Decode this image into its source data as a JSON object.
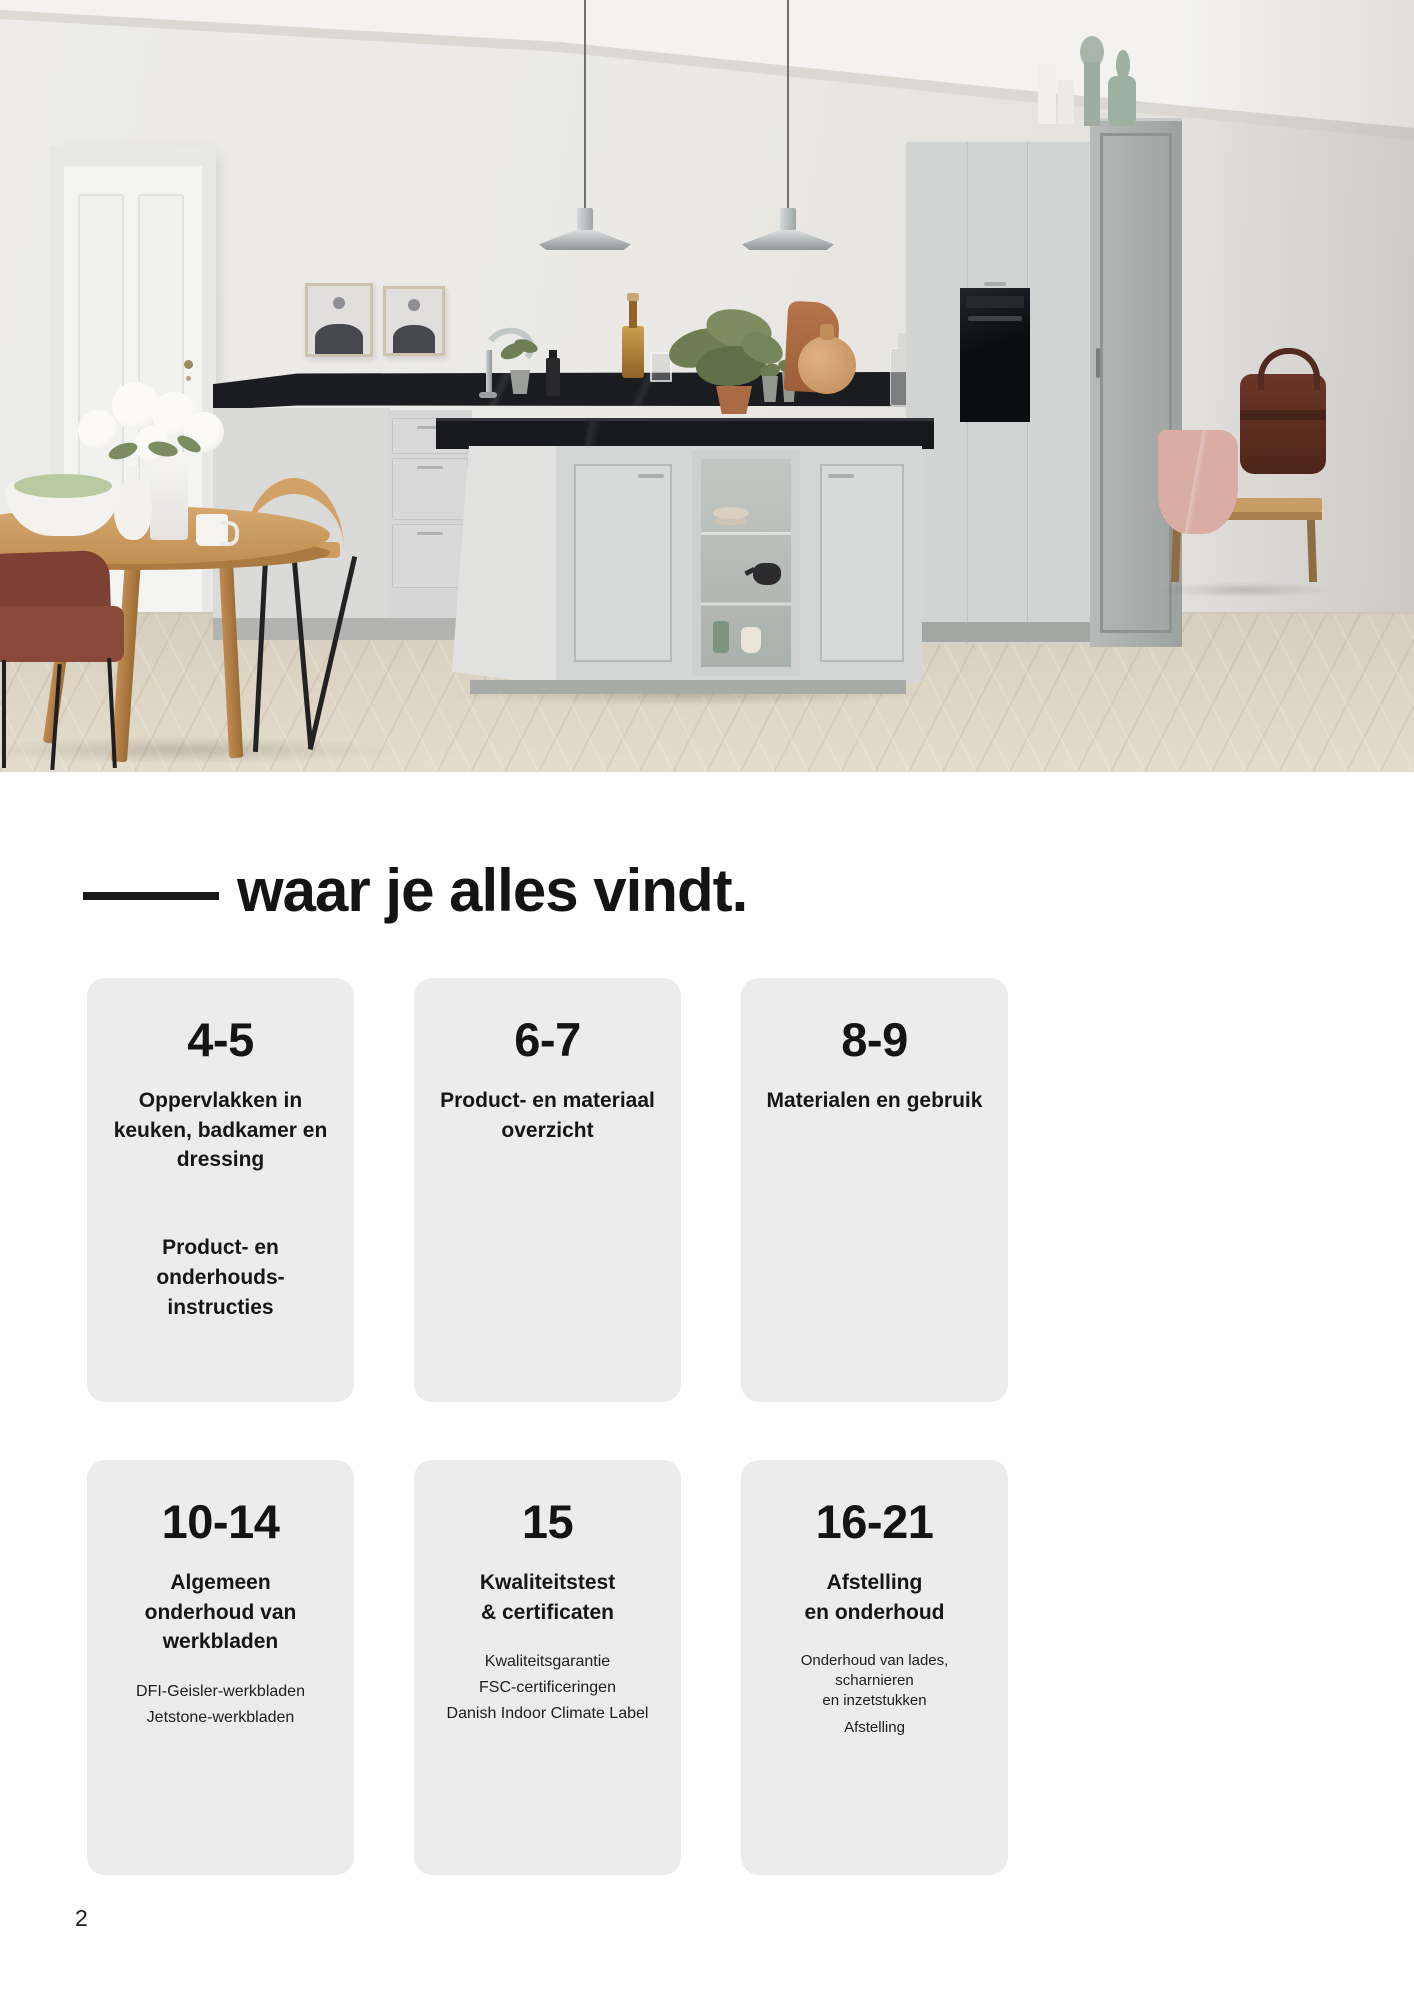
{
  "page": {
    "heading": "waar je alles vindt.",
    "page_number": "2"
  },
  "hero_photo": {
    "description": "Lichte keuken met grijs kookeiland, zwarte werkbladen, twee hanglampen, ronde houten eettafel met witte bloemen, witte deur en houten bank met leren tas"
  },
  "toc": {
    "cards": [
      {
        "pages": "4-5",
        "title_lines": [
          "Oppervlakken in",
          "keuken, badkamer en",
          "dressing"
        ],
        "secondary_title_lines": [
          "Product- en onderhouds-",
          "instructies"
        ]
      },
      {
        "pages": "6-7",
        "title_lines": [
          "Product- en materiaal",
          "overzicht"
        ]
      },
      {
        "pages": "8-9",
        "title_lines": [
          "Materialen en gebruik"
        ]
      },
      {
        "pages": "10-14",
        "title_lines": [
          "Algemeen",
          "onderhoud van",
          "werkbladen"
        ],
        "items": [
          {
            "lines": [
              "DFI-Geisler-werkbladen"
            ]
          },
          {
            "lines": [
              "Jetstone-werkbladen"
            ]
          }
        ]
      },
      {
        "pages": "15",
        "title_lines": [
          "Kwaliteitstest",
          "& certificaten"
        ],
        "items": [
          {
            "lines": [
              "Kwaliteitsgarantie"
            ]
          },
          {
            "lines": [
              "FSC-certificeringen"
            ]
          },
          {
            "lines": [
              "Danish Indoor Climate Label"
            ]
          }
        ]
      },
      {
        "pages": "16-21",
        "title_lines": [
          "Afstelling",
          "en onderhoud"
        ],
        "items": [
          {
            "lines": [
              "Onderhoud van lades, scharnieren",
              "en inzetstukken"
            ]
          },
          {
            "lines": [
              "Afstelling"
            ]
          }
        ]
      }
    ]
  },
  "colors": {
    "page_background": "#ffffff",
    "card_background": "#ececec",
    "heading_text": "#141414",
    "counter_black": "#1b1c1f",
    "cabinet_grey": "#d3d5d4",
    "wall_grey": "#e9e8e5",
    "floor_wood": "#dbd4c5",
    "table_wood": "#c08e52"
  }
}
